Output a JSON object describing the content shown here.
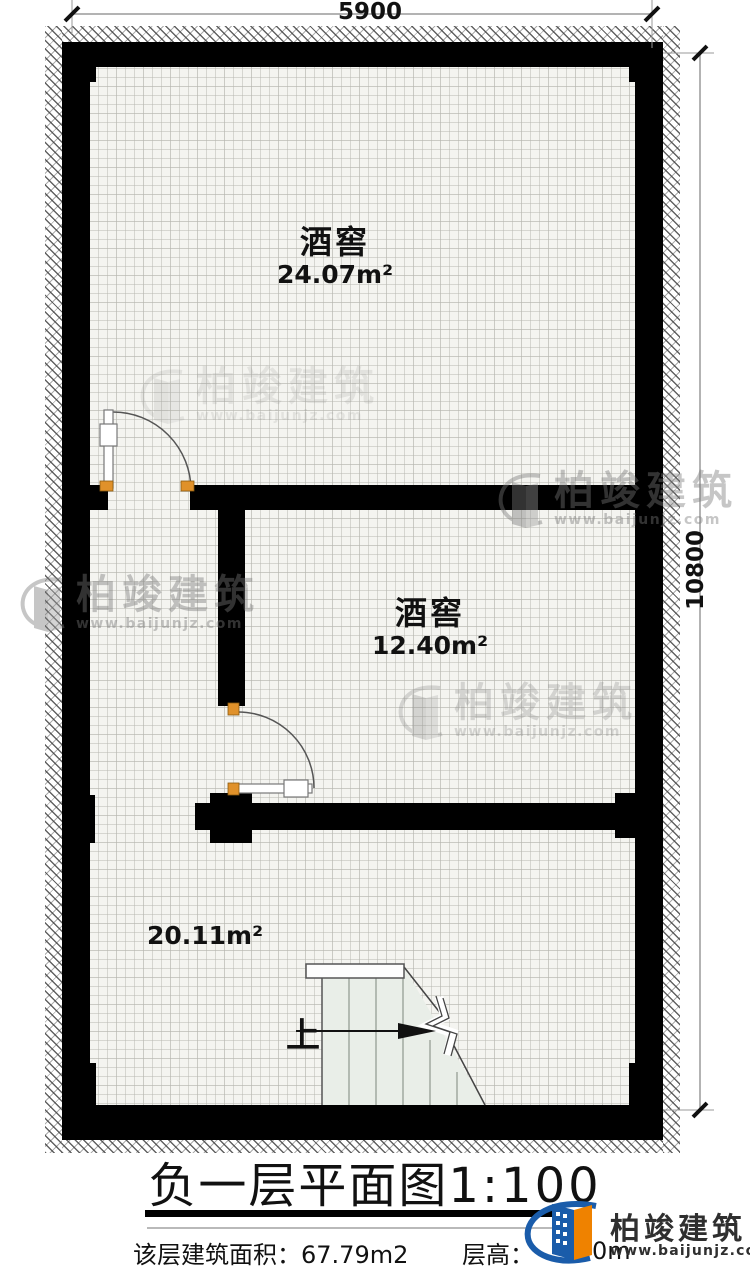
{
  "plan": {
    "dimensions": {
      "width_label": "5900",
      "height_label": "10800"
    },
    "rooms": [
      {
        "name": "酒窖",
        "area": "24.07m²"
      },
      {
        "name": "酒窖",
        "area": "12.40m²"
      },
      {
        "name": "",
        "area": "20.11m²"
      }
    ],
    "stairs": {
      "up_label": "上"
    }
  },
  "title": {
    "name": "负一层平面图",
    "scale": "1:100"
  },
  "footer": {
    "floor_area_label": "该层建筑面积：",
    "floor_area_value": "67.79m2",
    "floor_height_label": "层高：",
    "floor_height_value": "0m"
  },
  "brand": {
    "name": "柏竣建筑",
    "url": "www.baijunjz.com"
  },
  "watermark": {
    "name": "柏竣建筑",
    "url": "www.baijunjz.com"
  },
  "colors": {
    "wall": "#000000",
    "brand_blue": "#1a5caa",
    "brand_orange": "#ef8200",
    "hinge_orange": "#e0912a"
  }
}
